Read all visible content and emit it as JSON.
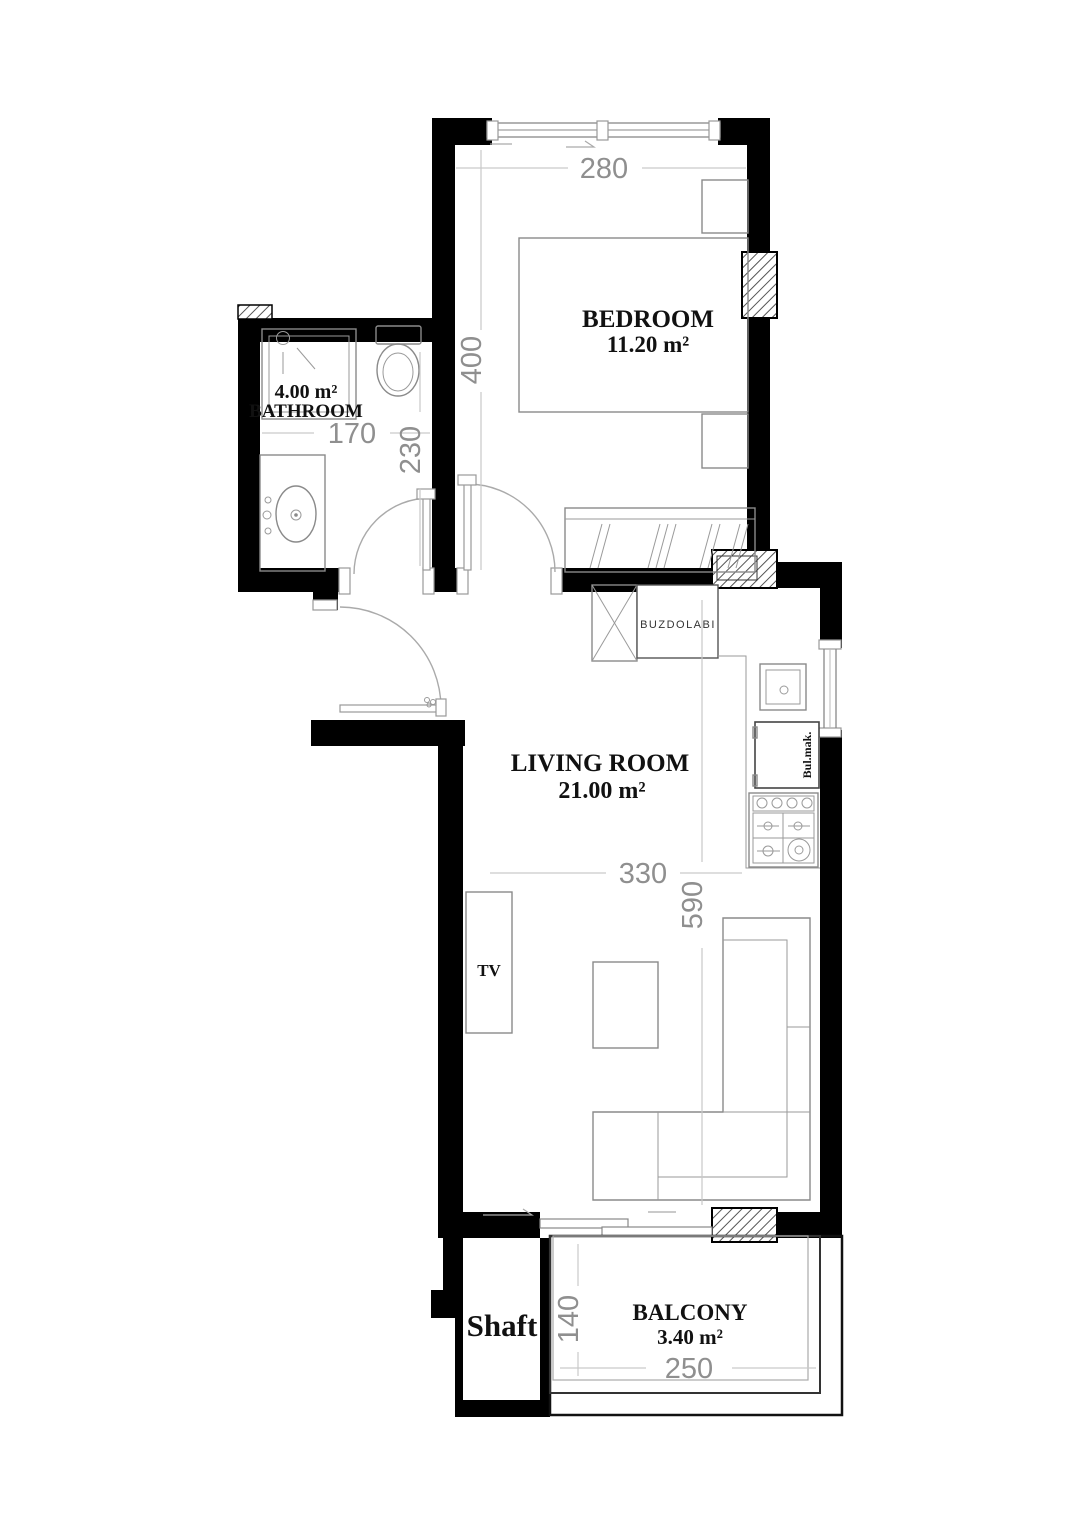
{
  "rooms": {
    "bedroom": {
      "name": "BEDROOM",
      "area": "11.20 m²"
    },
    "bathroom": {
      "area": "4.00 m²",
      "name": "BATHROOM"
    },
    "living": {
      "name": "LIVING ROOM",
      "area": "21.00 m²"
    },
    "balcony": {
      "name": "BALCONY",
      "area": "3.40 m²"
    },
    "shaft": {
      "name": "Shaft"
    }
  },
  "dims": {
    "bedroom_width": "280",
    "bedroom_depth": "400",
    "bathroom_width": "170",
    "hall_depth": "230",
    "living_width": "330",
    "living_depth": "590",
    "balcony_depth": "140",
    "balcony_width": "250"
  },
  "appliances": {
    "fridge": "BUZDOLABI",
    "dishwasher": "Bul.mak.",
    "tv": "TV"
  },
  "colors": {
    "wall": "#000000",
    "furniture_line": "#8a8a8a",
    "dim_text": "#8f8f8f",
    "label_text": "#111111"
  }
}
